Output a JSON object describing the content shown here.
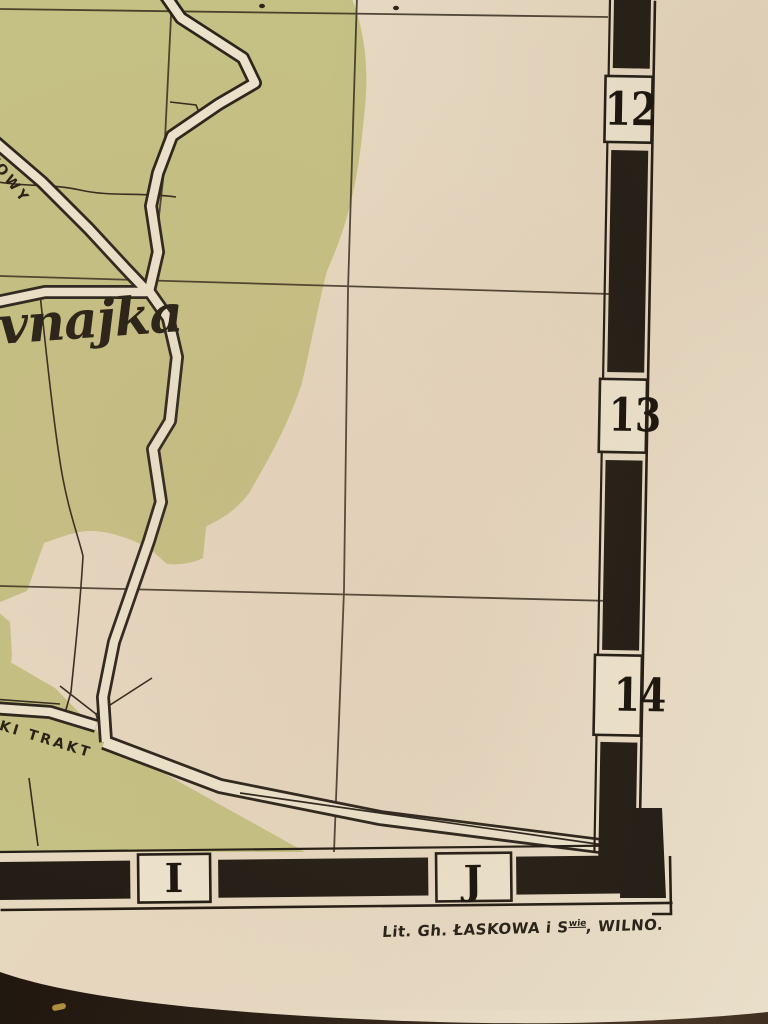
{
  "map": {
    "labels": {
      "river_cursive": "vnajka",
      "road_upper": "KOWY",
      "road_lower": "KI TRAKT"
    },
    "border": {
      "right_numbers": [
        "12",
        "13",
        "14"
      ],
      "bottom_letters": [
        "I",
        "J"
      ]
    },
    "caption": {
      "prefix": "Lit. Gh. ŁASKOWA i S",
      "superscript": "wie",
      "suffix": ", WILNO."
    },
    "colors": {
      "paper": "#e8dcc6",
      "terrain_green": "#c5c083",
      "ink": "#2e261b",
      "border_black": "#231d15",
      "photo_background": "#241a12"
    }
  }
}
